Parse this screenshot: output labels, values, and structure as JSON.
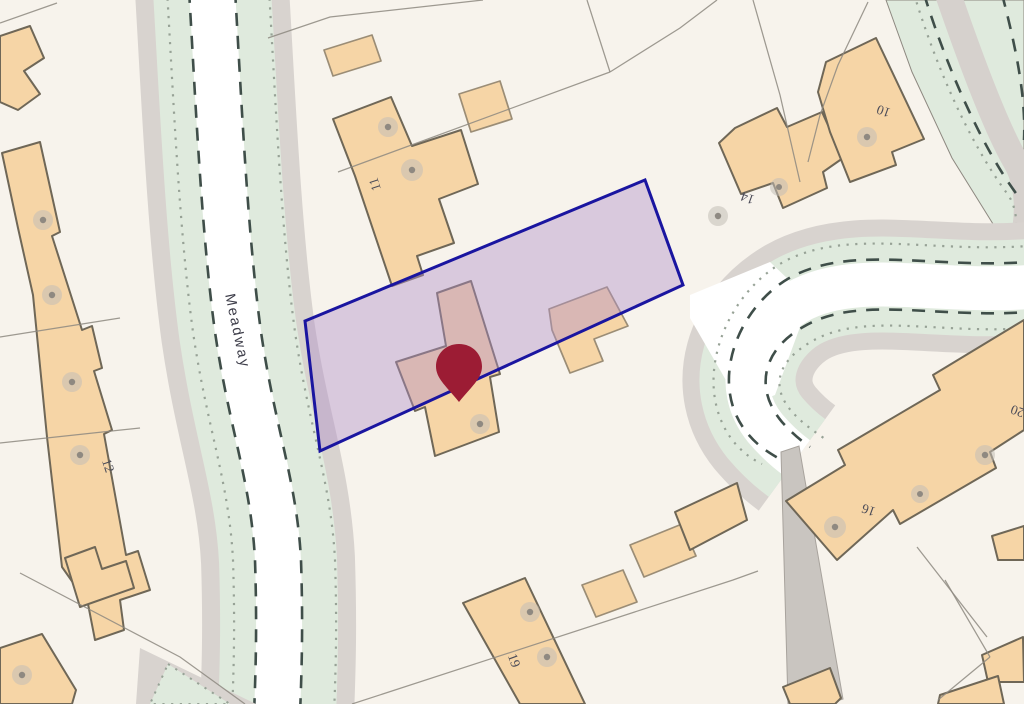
{
  "map_type": "property-location-map",
  "road": {
    "name": "Meadway"
  },
  "houses": [
    {
      "number": "11"
    },
    {
      "number": "12"
    },
    {
      "number": "14"
    },
    {
      "number": "10"
    },
    {
      "number": "16"
    },
    {
      "number": "19"
    },
    {
      "number": "20"
    }
  ],
  "selected_plot": {
    "fill_color": "#b18fc9",
    "outline_color": "#1a15a0"
  },
  "marker": {
    "kind": "location-pin",
    "color": "#9c1c34"
  },
  "palette": {
    "bg": "#f7f3ec",
    "road": "#ffffff",
    "verge": "#dfeadd",
    "pavement": "#d8d3cf",
    "path_gray": "#c9c5c0",
    "building": "#f6d5a6",
    "building_stroke": "#6f6757",
    "outbuilding_stroke": "#9b8d76",
    "parcel_line": "#8d8880",
    "road_dash": "#3f4e49",
    "dot_line": "#97a296",
    "plot_fill": "#b18fc9",
    "plot_stroke": "#1a15a0",
    "pin": "#9c1c34",
    "tree_outer": "#c2beb7",
    "tree_inner": "#8b867e",
    "label": "#4c4c58"
  }
}
